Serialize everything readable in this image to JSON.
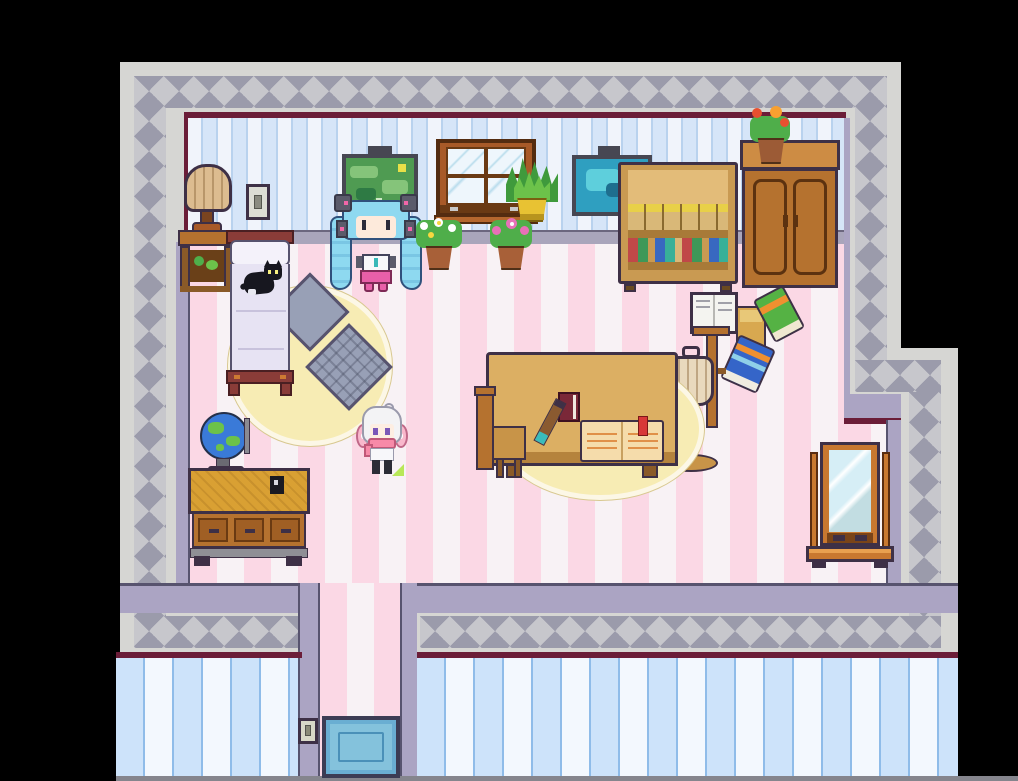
{
  "scene": {
    "title": "pixel-art bedroom (top-down RPG scene)",
    "characters": [
      {
        "id": "miku",
        "label": "teal twin-tailed girl with headphones",
        "pose": "sitting against north wall"
      },
      {
        "id": "roommate",
        "label": "white-haired girl with pink headphones",
        "pose": "standing mid-room"
      }
    ],
    "animals": [
      {
        "id": "cat",
        "label": "black cat sleeping on bed"
      }
    ],
    "furniture": [
      "table lamp on nightstand",
      "wall light switch",
      "bed",
      "green landscape painting",
      "window",
      "spiky potted plant",
      "white flower pot",
      "pink flower pot",
      "blue painting",
      "bookshelf",
      "wardrobe cabinet with flower pot",
      "round yellow rug",
      "plain diamond cushion",
      "quilted diamond cushion",
      "study table with open book, red book and pencil",
      "wooden chair",
      "coat stand",
      "floor lamp",
      "open notebook",
      "yellow book",
      "green book",
      "blue book",
      "drawer desk",
      "globe",
      "standing mirror",
      "blue doormat",
      "hallway switch"
    ],
    "palette": {
      "background": "#000000",
      "wall_edge_gray": "#d6d6d3",
      "wall_band_gray": "#9b9bab",
      "wall_band_light": "#c7c7cc",
      "wall_trim_lavender": "#aba4c3",
      "baseline_maroon": "#6b1d38",
      "wallpaper_blue": "#d6e5f8",
      "wallpaper_white": "#f1f4fb",
      "exterior_blue": "#cde3fa",
      "floor_pink": "#fbd8e5",
      "floor_white": "#f8f2f5",
      "wood_tan": "#c99a52",
      "wood_brown": "#b5722f",
      "rug_yellow": "#f7ecb4",
      "bed_frame_red": "#8a3c38",
      "mat_blue": "#6aaed2",
      "miku_hair": "#8ed9f0",
      "roommate_hair": "#f3f3f5"
    }
  }
}
